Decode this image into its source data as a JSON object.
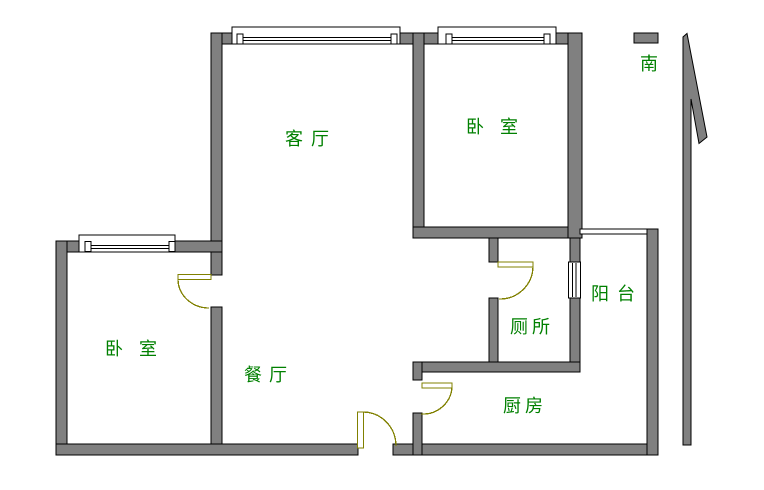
{
  "page": {
    "width": 764,
    "height": 490,
    "background": "#ffffff"
  },
  "palette": {
    "wall_fill": "#808080",
    "wall_outline": "#000000",
    "window_fill": "#ffffff",
    "door_color": "#808000",
    "label_color": "#008000"
  },
  "labels": {
    "living_room": "客厅",
    "bedroom_north": "卧室",
    "bedroom_west": "卧室",
    "dining_room": "餐厅",
    "toilet": "厕所",
    "kitchen": "厨房",
    "balcony": "阳台",
    "south": "南"
  }
}
